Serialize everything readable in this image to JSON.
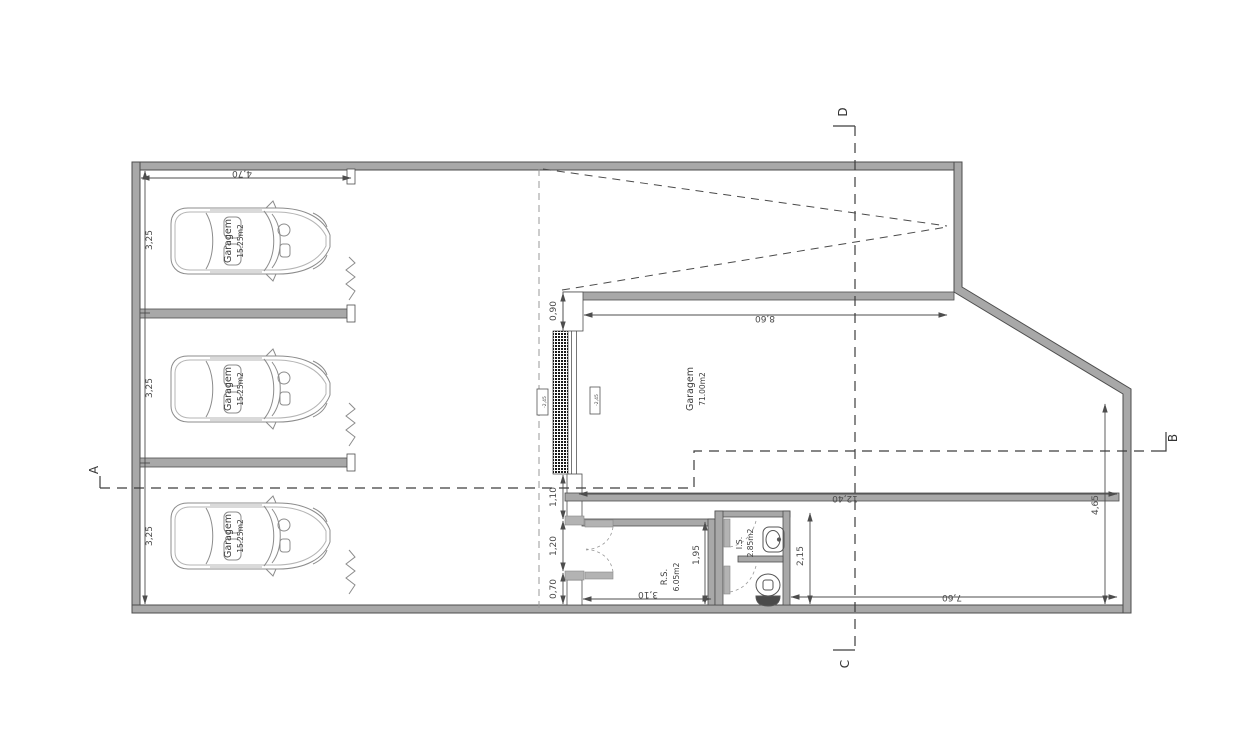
{
  "labels": {
    "stalls": [
      {
        "name": "Garagem",
        "area": "15.25m2",
        "depth": "3,25"
      },
      {
        "name": "Garagem",
        "area": "15.25m2",
        "depth": "3,25"
      },
      {
        "name": "Garagem",
        "area": "15.25m2",
        "depth": "3,25"
      }
    ],
    "big_garage": {
      "name": "Garagem",
      "area": "71.00m2"
    },
    "rs": {
      "name": "R.S.",
      "area": "6.05m2"
    },
    "is": {
      "name": "I.S.",
      "area": "2.85m2"
    }
  },
  "dimensions": {
    "stall_width": "4,70",
    "ramp_wall": "0,90",
    "below_ramp": "1,10",
    "rs_door": "1,20",
    "rs_stub": "0,70",
    "rs_width": "3,10",
    "rs_depth": "1,95",
    "is_depth": "2,15",
    "garage_width": "8,60",
    "lower_span": "12,40",
    "right_side": "4,65",
    "yard_width": "7,60"
  },
  "levels": {
    "ramp": "-2,45",
    "garage": "-2,45"
  },
  "sections": {
    "a": "A",
    "b": "B",
    "c": "C",
    "d": "D"
  },
  "colors": {
    "wall": "#a8a8a8",
    "line": "#4d4d4d",
    "light_line": "#8c8c8c",
    "dash": "#3d3d3d"
  }
}
